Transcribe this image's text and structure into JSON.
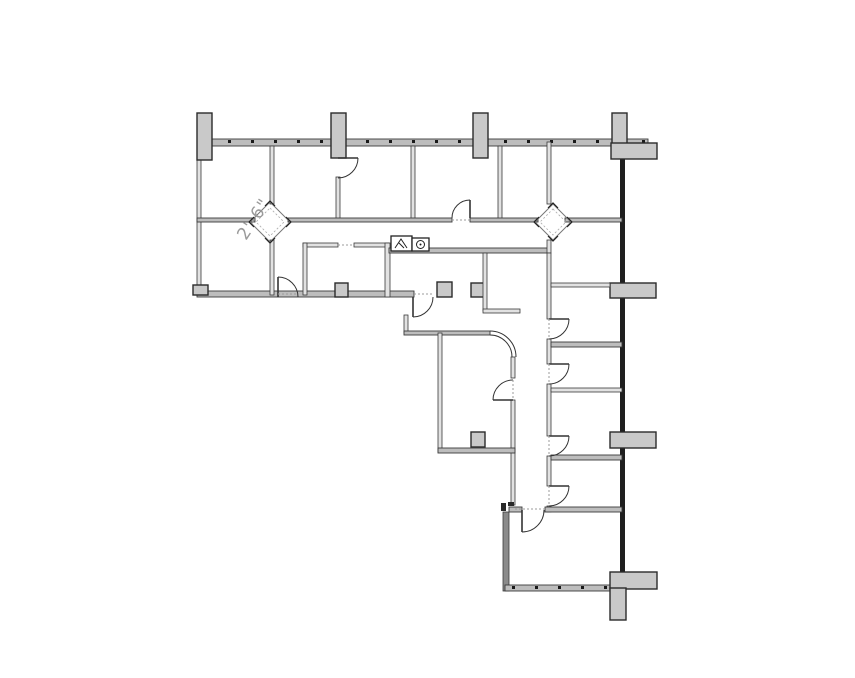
{
  "annotations": {
    "dimension_label": "2'-6\""
  },
  "palette": {
    "background": "#ffffff",
    "wall_fill": "#bdbdbd",
    "wall_fill_light": "#e2e2e2",
    "wall_edge": "#3a3a3a",
    "exterior_wall_dark": "#1f1f1f",
    "thick_gray_wall": "#8a8a8a",
    "column_fill": "#c9c9c9",
    "column_edge": "#2b2b2b",
    "door_line": "#333333",
    "dashed_line": "#9b9b9b",
    "mullion_dot": "#1a1a1a",
    "dimension_text": "#9a9a9a",
    "fixture_line": "#222222"
  },
  "fixtures": {
    "left_unit": "counter-appliance-icon",
    "right_unit": "round-sink-icon"
  }
}
